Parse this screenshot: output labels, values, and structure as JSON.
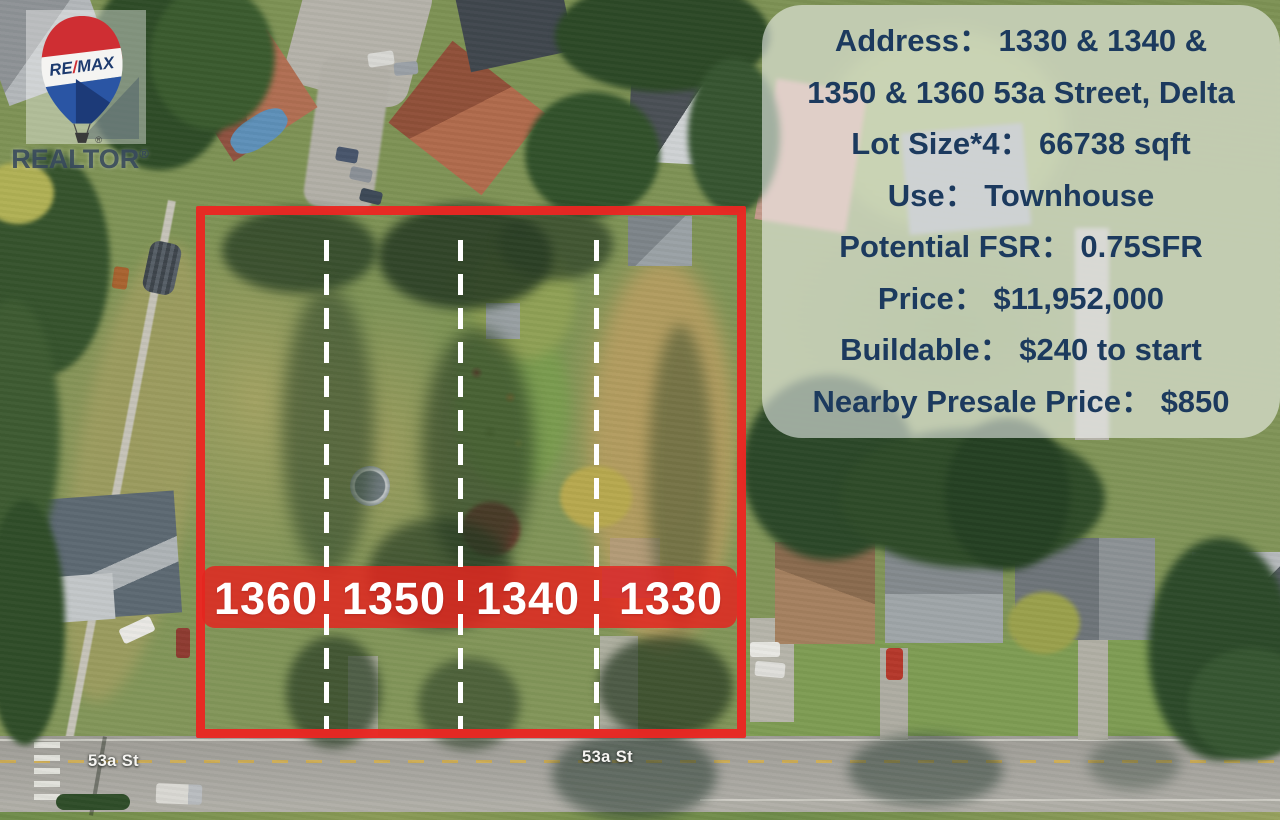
{
  "branding": {
    "balloon_re": "RE",
    "balloon_slash": "/",
    "balloon_max": "MAX",
    "realtor_text": "REALTOR",
    "registered_mark": "®"
  },
  "listing_panel": {
    "lines": [
      "Address：  1330 & 1340 &",
      "1350 & 1360 53a Street, Delta",
      "Lot Size*4：  66738 sqft",
      "Use：  Townhouse",
      "Potential FSR：  0.75SFR",
      "Price：  $11,952,000",
      "Buildable：  $240 to start",
      "Nearby Presale Price：  $850"
    ]
  },
  "lots": [
    {
      "number": "1360"
    },
    {
      "number": "1350"
    },
    {
      "number": "1340"
    },
    {
      "number": "1330"
    }
  ],
  "map": {
    "street_labels": [
      "53a St",
      "53a St"
    ]
  },
  "colors": {
    "annotation_red": "#ea2722",
    "band_red": "rgba(228,37,31,0.84)",
    "panel_text_navy": "#1c3a5e",
    "balloon_red": "#cf2e33",
    "balloon_blue": "#2a55a4",
    "road_gray": "#a6a49e"
  }
}
